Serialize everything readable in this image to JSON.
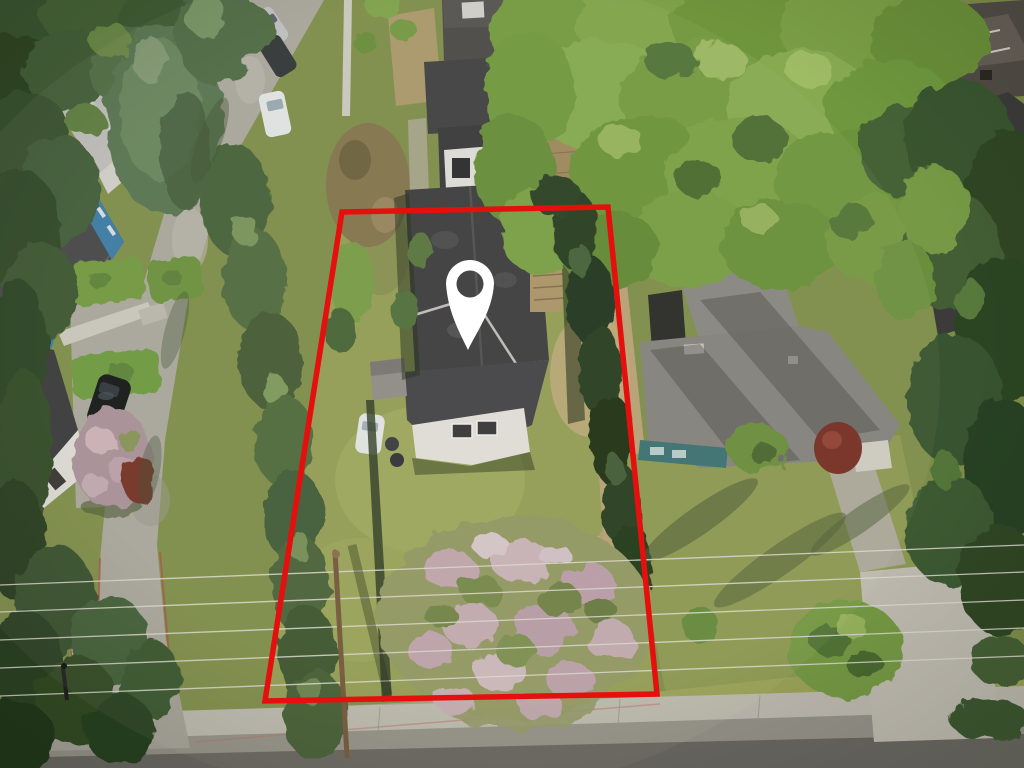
{
  "meta": {
    "kind": "aerial-property-listing-photo",
    "width": 1024,
    "height": 768,
    "description": "Drone aerial photo of a residential lot outlined in red with a white map location pin over the house roof"
  },
  "overlay": {
    "boundary_points": "342,212 608,207 657,694 265,701",
    "boundary_color": "#e50f0e",
    "boundary_stroke_width": "5.5",
    "pin_color": "#ffffff",
    "pin_path": "M468,350 C459,331 448,312 446,284 A24,24 0 1 1 494,284 C492,312 477,331 468,350 Z M456.5,284 a13.5,13.5 0 1 0 27,0 a13.5,13.5 0 1 0 -27,0 Z"
  },
  "palette": {
    "ground": "#85954e",
    "lot_lawn": "#9aa65a",
    "lawn_right": "#93a156",
    "dry_grass": "#c1aa7c",
    "street": "#b2afa5",
    "road": "#9c998f",
    "asphalt_dark": "#6f6c66",
    "sidewalk": "#c6c2b8",
    "subject_roof": "#414043",
    "neighbor_roof": "#8a8885",
    "blue_house": "#3f81ad",
    "teal_wall": "#3f7678",
    "deck_wood": "#b59b6f",
    "canopy_green": "#7aa244",
    "conifer_green": "#4a673c",
    "blossom_pink": "#c9adb5",
    "power_line": "#e8e5da",
    "crosswalk_white": "#eceae4",
    "red_curb": "#b5544a"
  },
  "scene": {
    "subject": "single-family house with dark gable roof, rear deck, shed, white car and backyard lawn inside red boundary",
    "left": "blue house with charcoal roof, hedges, driveway with two black cars, pink blossom tree",
    "right": "neighbor house with gray roof and teal walls, gravel driveway",
    "top": "street with parked cars, large green tree canopy, dark-roof houses",
    "bottom": "main road with sidewalk, crosswalk, power lines and utility pole"
  }
}
